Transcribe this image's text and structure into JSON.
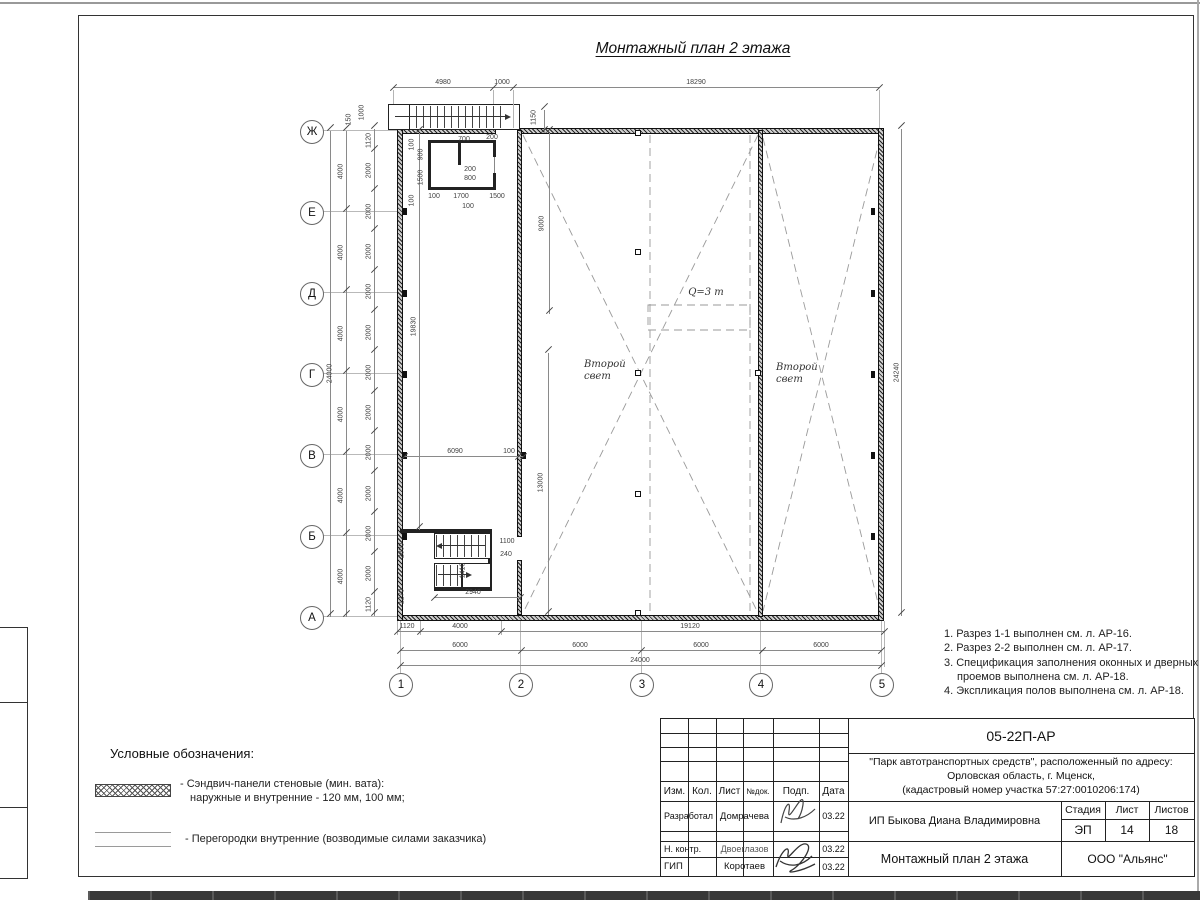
{
  "sheet": {
    "title": "Монтажный план 2 этажа"
  },
  "notes": [
    "1. Разрез 1-1 выполнен см. л. АР-16.",
    "2. Разрез 2-2 выполнен см. л. АР-17.",
    "3. Спецификация заполнения оконных и дверных проемов выполнена см. л. АР-18.",
    "4. Экспликация полов выполнена см. л. АР-18."
  ],
  "legend": {
    "title": "Условные обозначения:",
    "item1_line1": "- Сэндвич-панели стеновые (мин. вата):",
    "item1_line2": "наружные и внутренние - 120 мм, 100 мм;",
    "item2": "- Перегородки внутренние (возводимые силами заказчика)"
  },
  "labels": {
    "second_light": "Второй свет",
    "crane": "Q=3 т"
  },
  "grid": {
    "rows": [
      "Ж",
      "Е",
      "Д",
      "Г",
      "В",
      "Б",
      "А"
    ],
    "cols": [
      "1",
      "2",
      "3",
      "4",
      "5"
    ]
  },
  "dims": {
    "top_4980": "4980",
    "top_1000": "1000",
    "top_18290": "18290",
    "vest_1150": "1150",
    "s_150": "150",
    "s_1000": "1000",
    "left_total": "24000",
    "bay": "4000",
    "panel_end": "1120",
    "panel": "2000",
    "wall_19830": "19830",
    "h_9000": "9000",
    "h_13000": "13000",
    "w_6090": "6090",
    "w_100": "100",
    "right_total": "24240",
    "bot_1120": "1120",
    "bot_4000": "4000",
    "bot_19120": "19120",
    "bot_6000": "6000",
    "bot_total": "24000",
    "shaft": {
      "a": "100",
      "b": "900",
      "c": "1500",
      "d": "100",
      "e": "700",
      "f": "200",
      "g": "200",
      "h": "800",
      "j": "100",
      "k": "1700",
      "l": "1500",
      "m": "100"
    },
    "stair": {
      "a": "2800",
      "b": "1270",
      "c": "1410",
      "d": "1100",
      "e": "240",
      "f": "2940"
    }
  },
  "tb": {
    "doc_number": "05-22П-АР",
    "project1": "\"Парк автотранспортных средств\",  расположенный по адресу:",
    "project2": "Орловская область, г. Мценск,",
    "project3": "(кадастровый номер участка 57:27:0010206:174)",
    "h_izm": "Изм.",
    "h_kol": "Кол.",
    "h_list": "Лист",
    "h_ndok": "№док.",
    "h_podp": "Подп.",
    "h_data": "Дата",
    "r1_role": "Разработал",
    "r1_name": "Домрачева",
    "r1_date": "03.22",
    "r2_role": "Н. контр.",
    "r2_name": "Двоеглазов",
    "r2_date": "03.22",
    "r3_role": "ГИП",
    "r3_name": "Коротаев",
    "r3_date": "03.22",
    "client": "ИП Быкова Диана Владимировна",
    "h_stage": "Стадия",
    "h_sheet": "Лист",
    "h_sheets": "Листов",
    "stage": "ЭП",
    "sheet_no": "14",
    "sheets_total": "18",
    "drawing_title": "Монтажный план 2 этажа",
    "company": "ООО \"Альянс\""
  }
}
